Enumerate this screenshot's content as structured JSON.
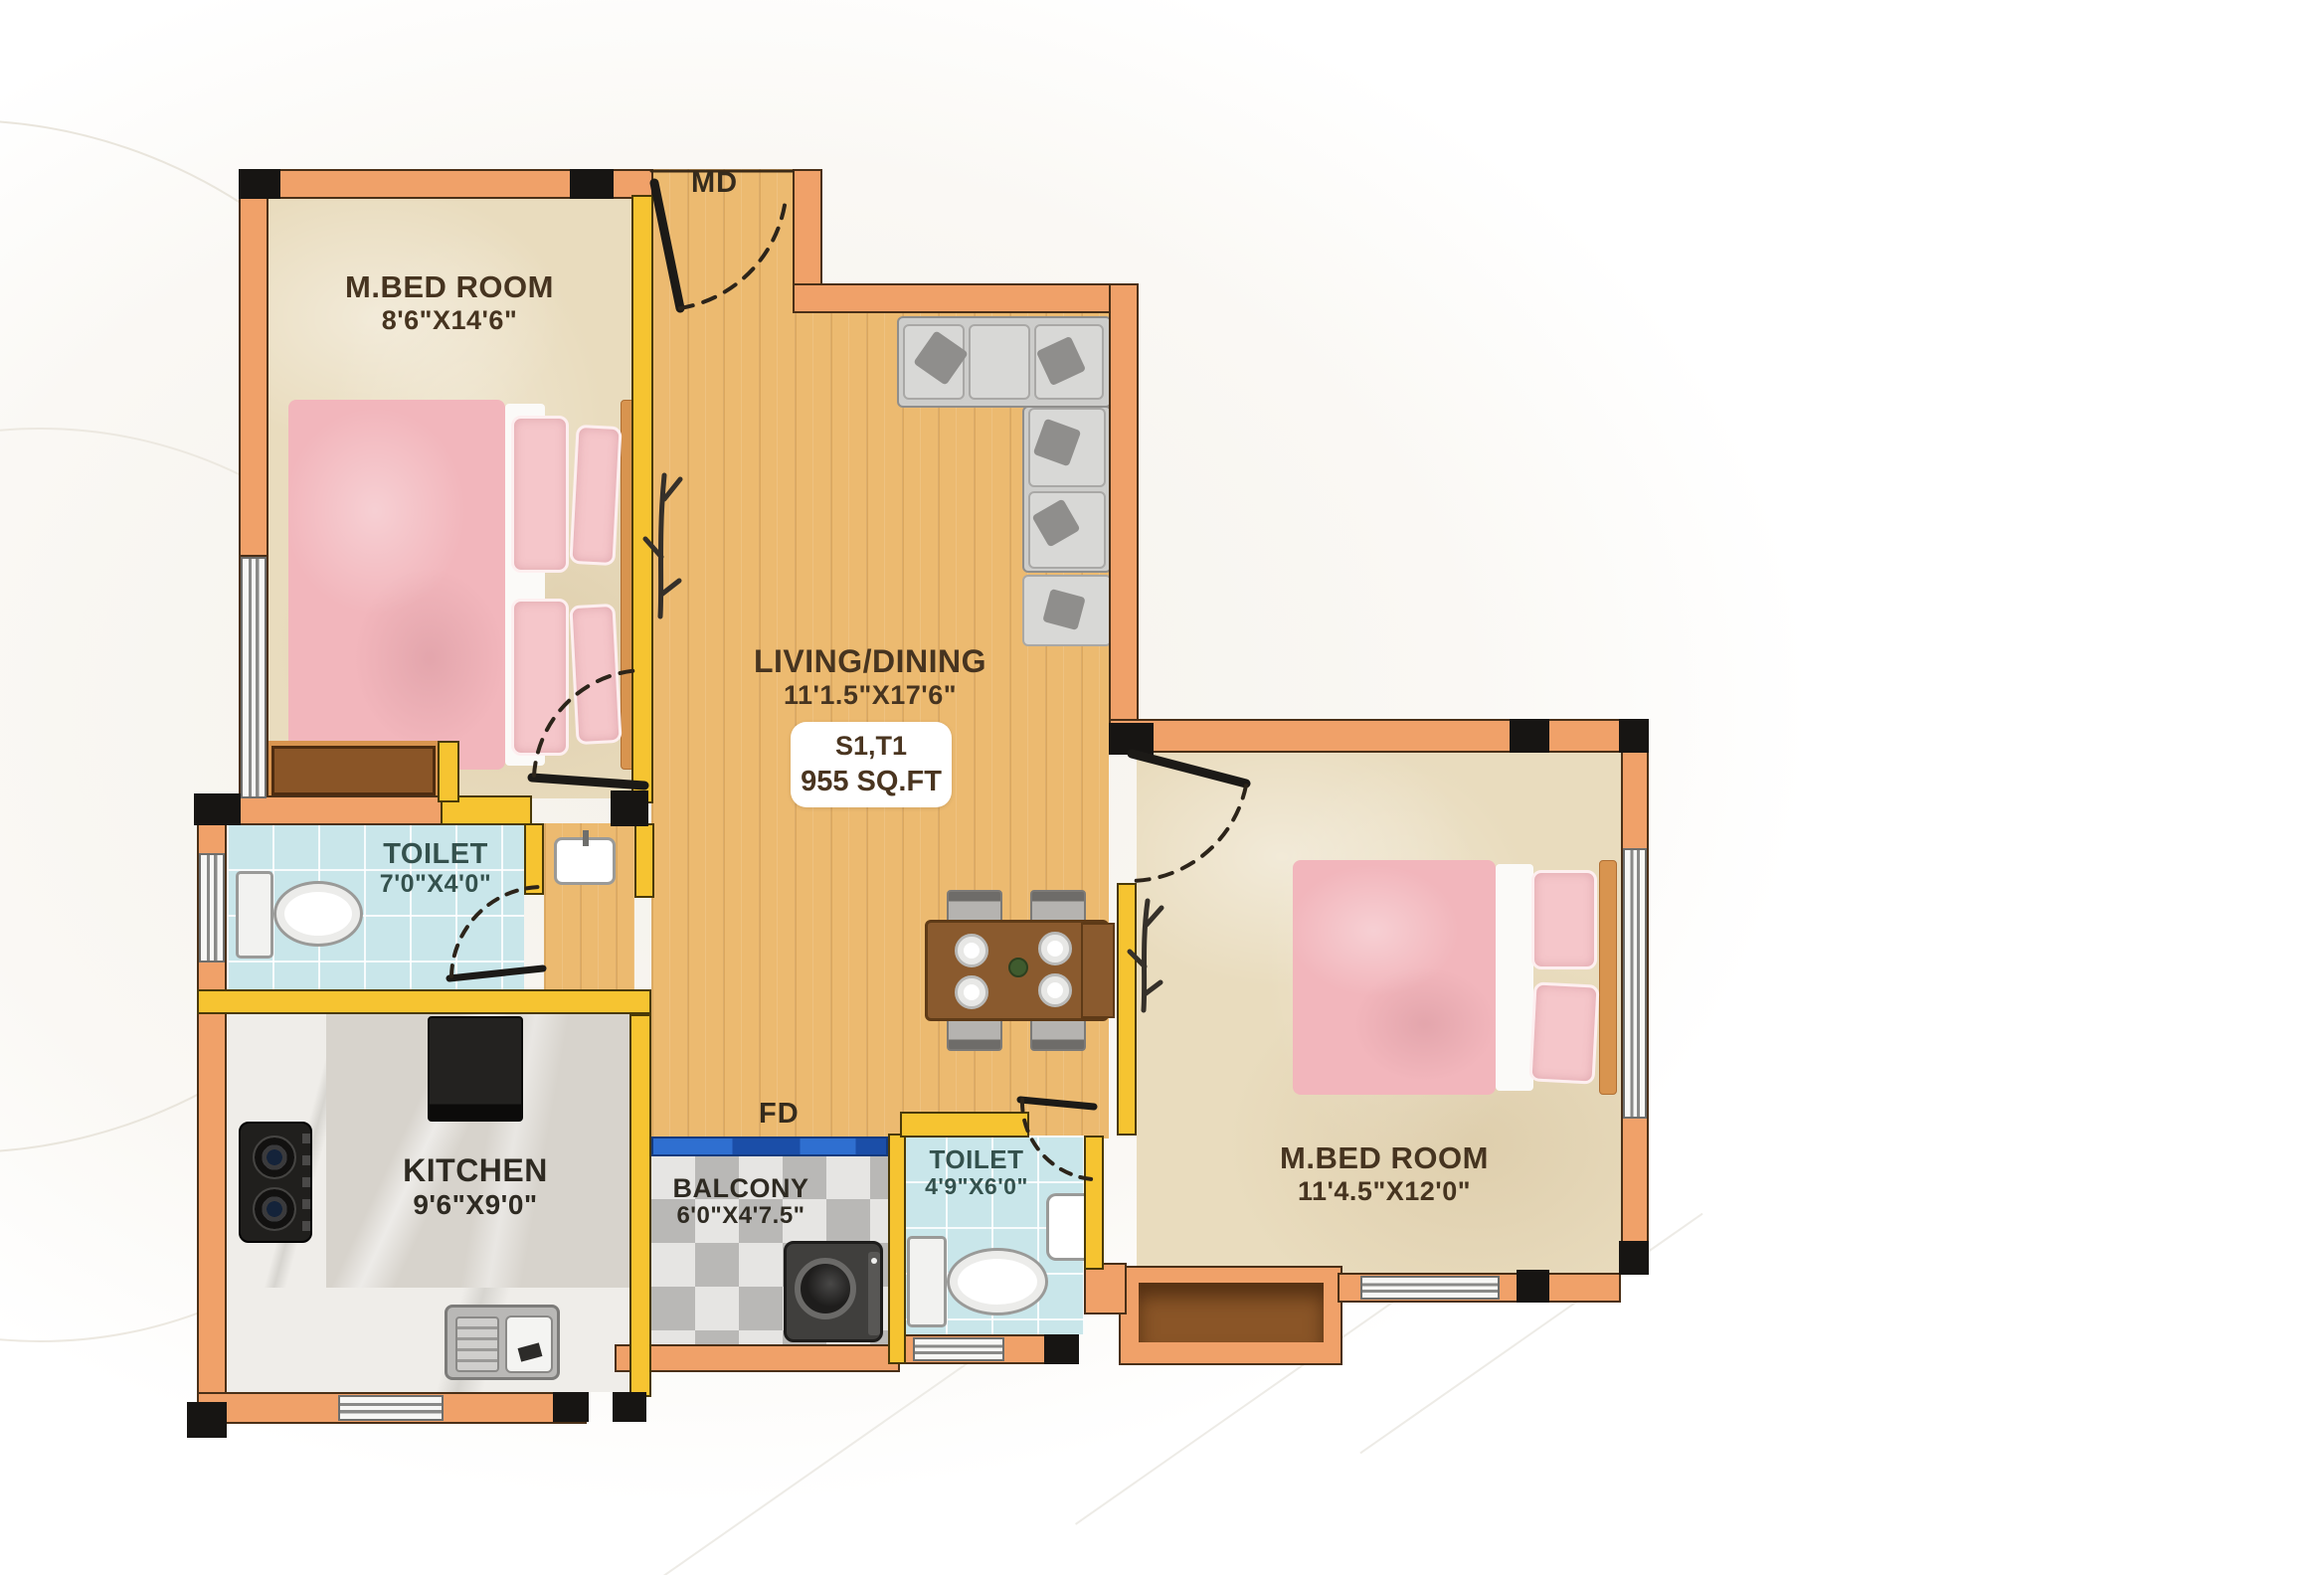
{
  "plan": {
    "unit_badge": {
      "unit": "S1,T1",
      "area": "955 SQ.FT"
    },
    "door_labels": {
      "main_door": "MD",
      "french_door": "FD"
    },
    "rooms": {
      "bedroom1": {
        "name": "M.BED ROOM",
        "dims": "8'6\"X14'6\""
      },
      "living": {
        "name": "LIVING/DINING",
        "dims": "11'1.5\"X17'6\""
      },
      "toilet1": {
        "name": "TOILET",
        "dims": "7'0\"X4'0\""
      },
      "kitchen": {
        "name": "KITCHEN",
        "dims": "9'6\"X9'0\""
      },
      "balcony": {
        "name": "BALCONY",
        "dims": "6'0\"X4'7.5\""
      },
      "toilet2": {
        "name": "TOILET",
        "dims": "4'9\"X6'0\""
      },
      "bedroom2": {
        "name": "M.BED ROOM",
        "dims": "11'4.5\"X12'0\""
      }
    },
    "colors": {
      "wall_orange": "#f0a169",
      "wall_yellow": "#f6c431",
      "wood_floor": "#ecba70",
      "tile_blue": "#c9e6ea",
      "door_blue": "#2f6fd0",
      "bed_pink": "#f2b6bc"
    }
  }
}
